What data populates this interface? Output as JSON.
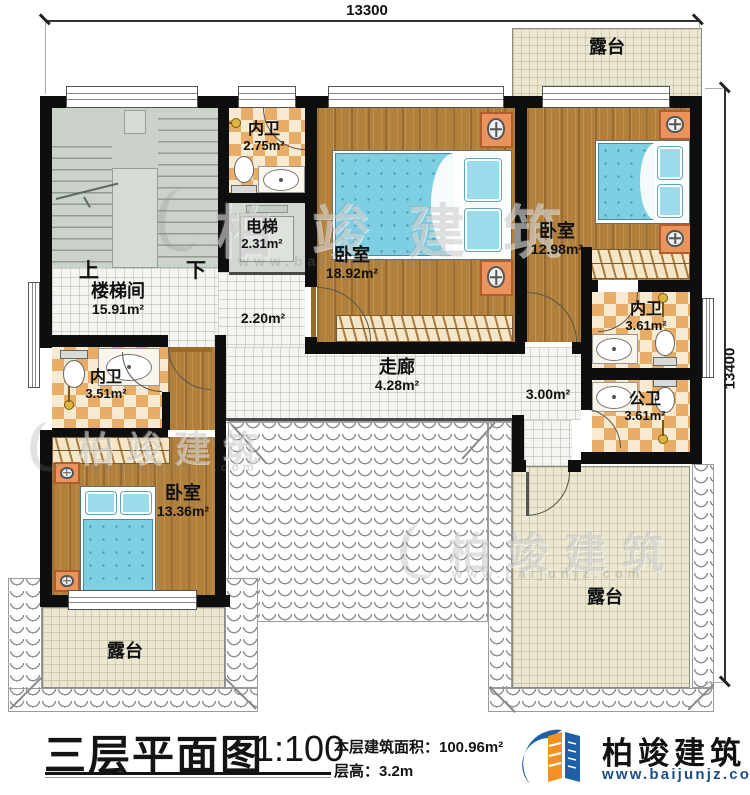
{
  "dimensions": {
    "top": "13300",
    "right": "13400"
  },
  "rooms": {
    "terrace_top": {
      "name": "露台"
    },
    "bath_top": {
      "name": "内卫",
      "area": "2.75m²"
    },
    "elevator": {
      "name": "电梯",
      "area": "2.31m²"
    },
    "bedroom_main": {
      "name": "卧室",
      "area": "18.92m²"
    },
    "bedroom_right": {
      "name": "卧室",
      "area": "12.98m²"
    },
    "stairwell": {
      "name": "楼梯间",
      "area": "15.91m²"
    },
    "corridor_link": {
      "area": "2.20m²"
    },
    "corridor": {
      "name": "走廊",
      "area": "4.28m²"
    },
    "corridor_right": {
      "area": "3.00m²"
    },
    "bath_right": {
      "name": "内卫",
      "area": "3.61m²"
    },
    "bath_public": {
      "name": "公卫",
      "area": "3.61m²"
    },
    "bath_left": {
      "name": "内卫",
      "area": "3.51m²"
    },
    "bedroom_left": {
      "name": "卧室",
      "area": "13.36m²"
    },
    "terrace_left": {
      "name": "露台"
    },
    "terrace_right": {
      "name": "露台"
    }
  },
  "stairs": {
    "up": "上",
    "down": "下"
  },
  "titleblock": {
    "title": "三层平面图",
    "scale": "1:100",
    "area_label": "本层建筑面积：100.96m²",
    "height_label": "层高：3.2m"
  },
  "brand": {
    "name": "柏竣建筑",
    "url": "www.baijunjz.com"
  },
  "watermark": {
    "text": "柏竣建筑",
    "url": "www.baijunjz.com"
  }
}
